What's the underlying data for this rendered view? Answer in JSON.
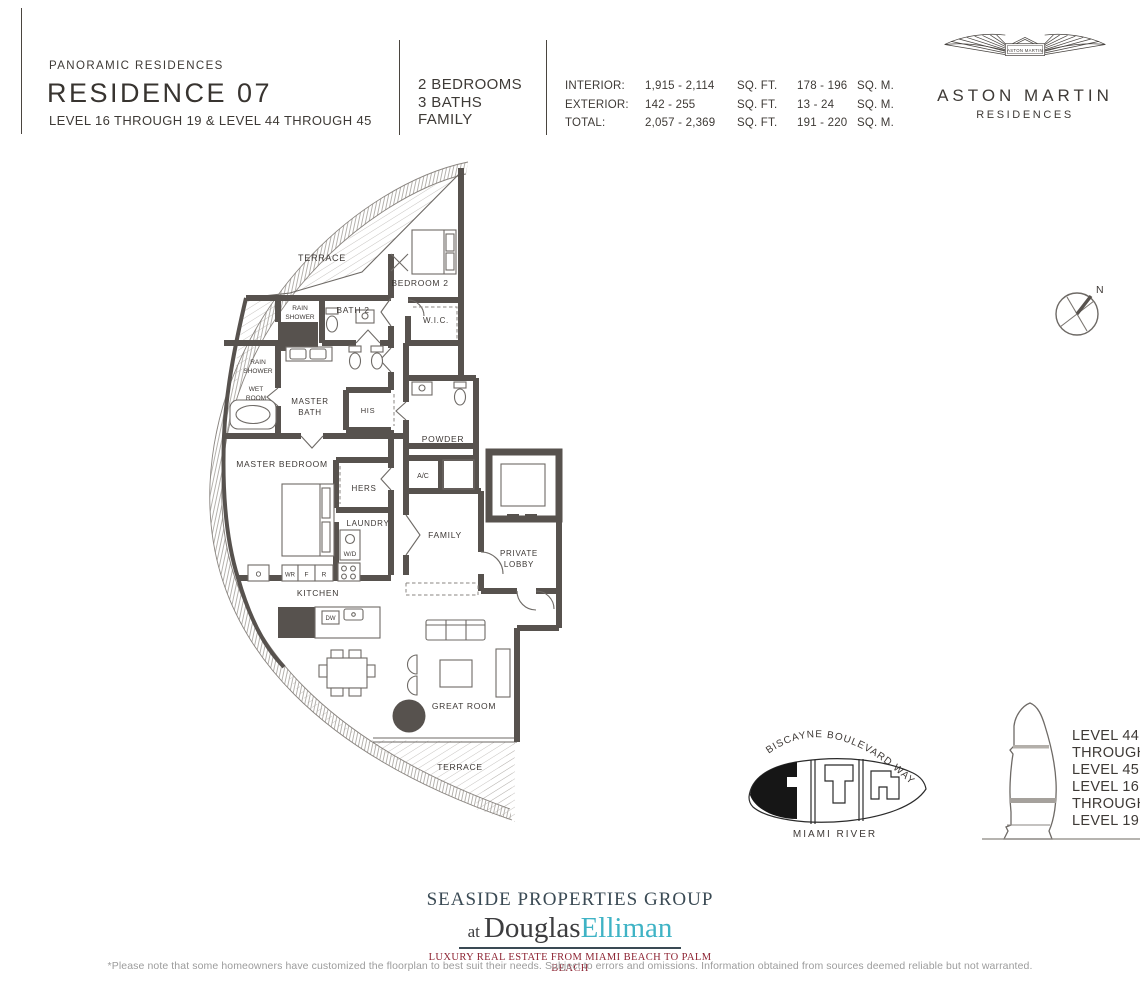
{
  "header": {
    "eyebrow": "PANORAMIC RESIDENCES",
    "title": "RESIDENCE 07",
    "levels": "LEVEL 16 THROUGH 19 & LEVEL 44 THROUGH 45",
    "features": [
      "2 BEDROOMS",
      "3 BATHS",
      "FAMILY"
    ],
    "area_table": [
      {
        "label": "INTERIOR:",
        "sqft": "1,915 - 2,114",
        "sqft_unit": "SQ. FT.",
        "sqm": "178 - 196",
        "sqm_unit": "SQ. M."
      },
      {
        "label": "EXTERIOR:",
        "sqft": "142 - 255",
        "sqft_unit": "SQ. FT.",
        "sqm": "13 - 24",
        "sqm_unit": "SQ. M."
      },
      {
        "label": "TOTAL:",
        "sqft": "2,057 - 2,369",
        "sqft_unit": "SQ. FT.",
        "sqm": "191 - 220",
        "sqm_unit": "SQ. M."
      }
    ]
  },
  "logo": {
    "badge": "ASTON MARTIN",
    "name": "ASTON MARTIN",
    "sub": "RESIDENCES"
  },
  "floorplan": {
    "labels": {
      "terrace_top": "TERRACE",
      "bedroom2": "BEDROOM 2",
      "bath2": "BATH 2",
      "rain1a": "RAIN",
      "rain1b": "SHOWER",
      "wic": "W.I.C.",
      "rain2a": "RAIN",
      "rain2b": "SHOWER",
      "weta": "WET",
      "wetb": "ROOM",
      "mbatha": "MASTER",
      "mbathb": "BATH",
      "his": "HIS",
      "powder": "POWDER",
      "master_bedroom": "MASTER BEDROOM",
      "ac": "A/C",
      "hers": "HERS",
      "laundry": "LAUNDRY",
      "wd": "W/D",
      "family": "FAMILY",
      "lobbya": "PRIVATE",
      "lobbyb": "LOBBY",
      "kitchen": "KITCHEN",
      "o": "O",
      "wr": "WR",
      "f": "F",
      "r": "R",
      "dw": "DW",
      "great_room": "GREAT ROOM",
      "terrace_bottom": "TERRACE"
    }
  },
  "compass": {
    "n": "N"
  },
  "sitemap": {
    "street": "BISCAYNE BOULEVARD WAY",
    "river": "MIAMI RIVER"
  },
  "elevation": {
    "upper": [
      "LEVEL 44",
      "THROUGH",
      "LEVEL 45"
    ],
    "lower": [
      "LEVEL 16",
      "THROUGH",
      "LEVEL 19"
    ]
  },
  "footer": {
    "group": "SEASIDE PROPERTIES GROUP",
    "at": "at",
    "name1": "Douglas",
    "name2": "Elliman",
    "tagline": "LUXURY REAL ESTATE FROM MIAMI BEACH TO PALM BEACH",
    "disclaimer": "*Please note that some homeowners have customized the floorplan to best suit their needs. Subject to errors and omissions. Information obtained from sources deemed reliable but not warranted."
  },
  "colors": {
    "wall": "#57524e",
    "brand_navy": "#3a4a54",
    "accent_teal": "#3fb3c5",
    "tagline_red": "#8d2332"
  }
}
